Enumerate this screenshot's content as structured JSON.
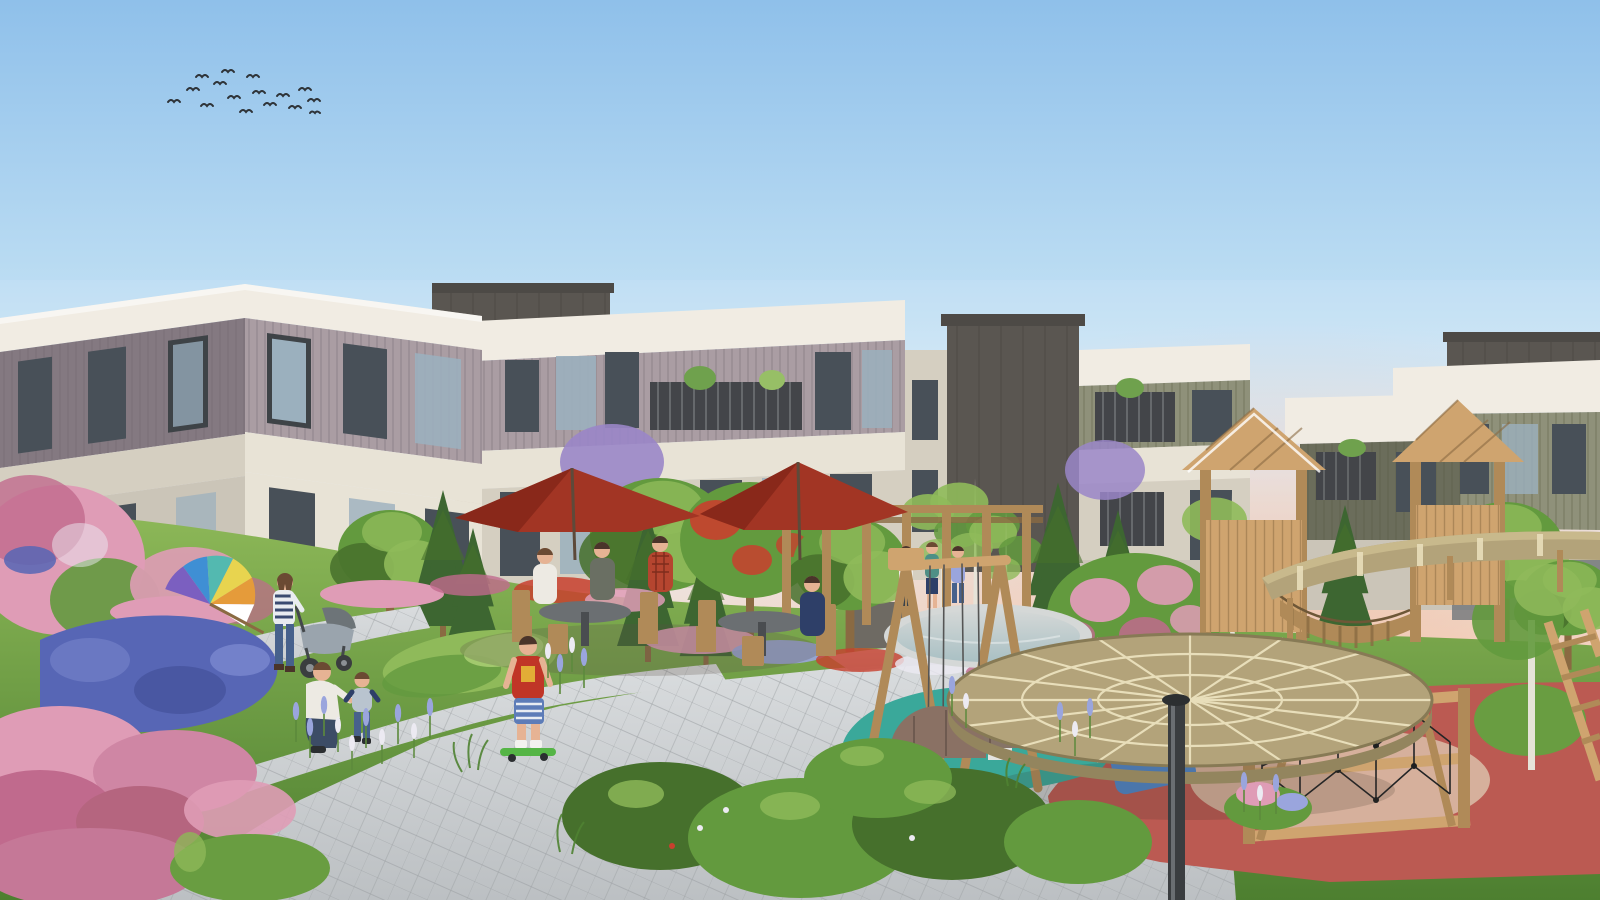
{
  "scene": {
    "title": "Residential complex courtyard rendering",
    "description": "Architectural rendering at dawn: modern 3-4 storey apartment blocks with cream fascia bands, mauve and olive cladding, around a landscaped courtyard garden with stone paths, flower beds, an outdoor cafe with red umbrellas, a wooden pergola, and a children's playground with timber towers, round timber canopies, a swing set, climbing net, small pond and colourful rubber surfacing; residents stroll and children play; a flock of birds crosses the blue-to-pink sky.",
    "elements": [
      "flock-of-birds",
      "apartment-building-left",
      "apartment-building-center-left",
      "apartment-building-center",
      "apartment-building-right",
      "rooftop-dark-volumes",
      "balconies-with-plants",
      "garden-flower-beds",
      "lavender-blue-flowers",
      "pink-heather",
      "white-flower-spikes",
      "pink-blossom-tree",
      "red-flowering-tree",
      "birch-trees",
      "conifers",
      "stone-paving-paths",
      "outdoor-cafe-tables",
      "red-cafe-umbrellas",
      "wooden-pergola",
      "swing-set",
      "spring-riders",
      "round-timber-canopy",
      "elevated-timber-ring",
      "playhouse-towers",
      "plank-bridge",
      "climbing-net",
      "wooden-ladder",
      "pond",
      "teal-rubber-surface",
      "red-rubber-surface",
      "blue-gym-mat",
      "mother-with-stroller",
      "father-with-toddler",
      "boy-on-skateboard",
      "rainbow-umbrella-on-lawn",
      "people-at-cafe",
      "people-under-pergola"
    ]
  },
  "palette": {
    "sky-top": "#8fc0ea",
    "sky-mid": "#bcddf3",
    "sky-low": "#e3effa",
    "sky-pink": "#f4d2bd",
    "sky-pink-strong": "#f0bda2",
    "fascia-white": "#f0ebe1",
    "cream-light": "#e7e1d3",
    "cream-shadow": "#d2cbbc",
    "wall-grey": "#c7c0b2",
    "mauve-light": "#a3959c",
    "mauve-dark": "#7a6e77",
    "olive-light": "#86886f",
    "olive-dark": "#5f614e",
    "charcoal": "#4c4843",
    "charcoal-dark": "#3e3b37",
    "window-dark": "#39424a",
    "window-glass": "#93aab9",
    "window-frame": "#2e3338",
    "railing": "#33363a",
    "wood-light": "#cfa46f",
    "wood-mid": "#b08a58",
    "wood-dark": "#8a6a42",
    "canopy-top": "#b3a37a",
    "canopy-edge": "#93855e",
    "canopy-line": "#e8deba",
    "path-light": "#d9dcde",
    "path-mid": "#bcc0c3",
    "path-joint": "#9b9fa2",
    "grass-light": "#8db858",
    "grass-mid": "#699d41",
    "grass-dark": "#4d7f30",
    "leaf-light": "#8fba5a",
    "leaf-mid": "#639a3e",
    "leaf-dark": "#46702c",
    "conifer": "#3d6631",
    "birch-trunk": "#e6e3d8",
    "flower-pink": "#df9cb6",
    "flower-magenta": "#c06a8d",
    "flower-blue": "#5766b5",
    "flower-lilac": "#9aa5dd",
    "flower-white": "#eceaf2",
    "flower-red": "#c8402e",
    "flower-purple": "#9a86c8",
    "umbrella-red": "#a23524",
    "umbrella-red-dark": "#7f2417",
    "rubber-teal": "#3aa89a",
    "rubber-red": "#bb5a52",
    "rubber-red-light": "#cc6f63",
    "sand": "#d9b9a4",
    "pond": "#a9c0c4",
    "pond-rim": "#d5d8d7",
    "pole-dark": "#3a3d40",
    "mat-blue": "#4f86c9",
    "net-black": "#222426",
    "bird-dark": "#2e3338",
    "skin": "#e6b394",
    "hair-dark": "#4a342a",
    "hair-brown": "#6b4a33",
    "shirt-red": "#c03527",
    "shorts-blue": "#5d7cb8",
    "skateboard-green": "#55b546",
    "jacket-white": "#edeae3",
    "jeans": "#47618c",
    "navy": "#2e3f68",
    "stroller-gray": "#9aa4ad",
    "plaid-red": "#b5452f",
    "teal-shirt": "#4e8f86",
    "spring-rider": "#8a7164"
  }
}
